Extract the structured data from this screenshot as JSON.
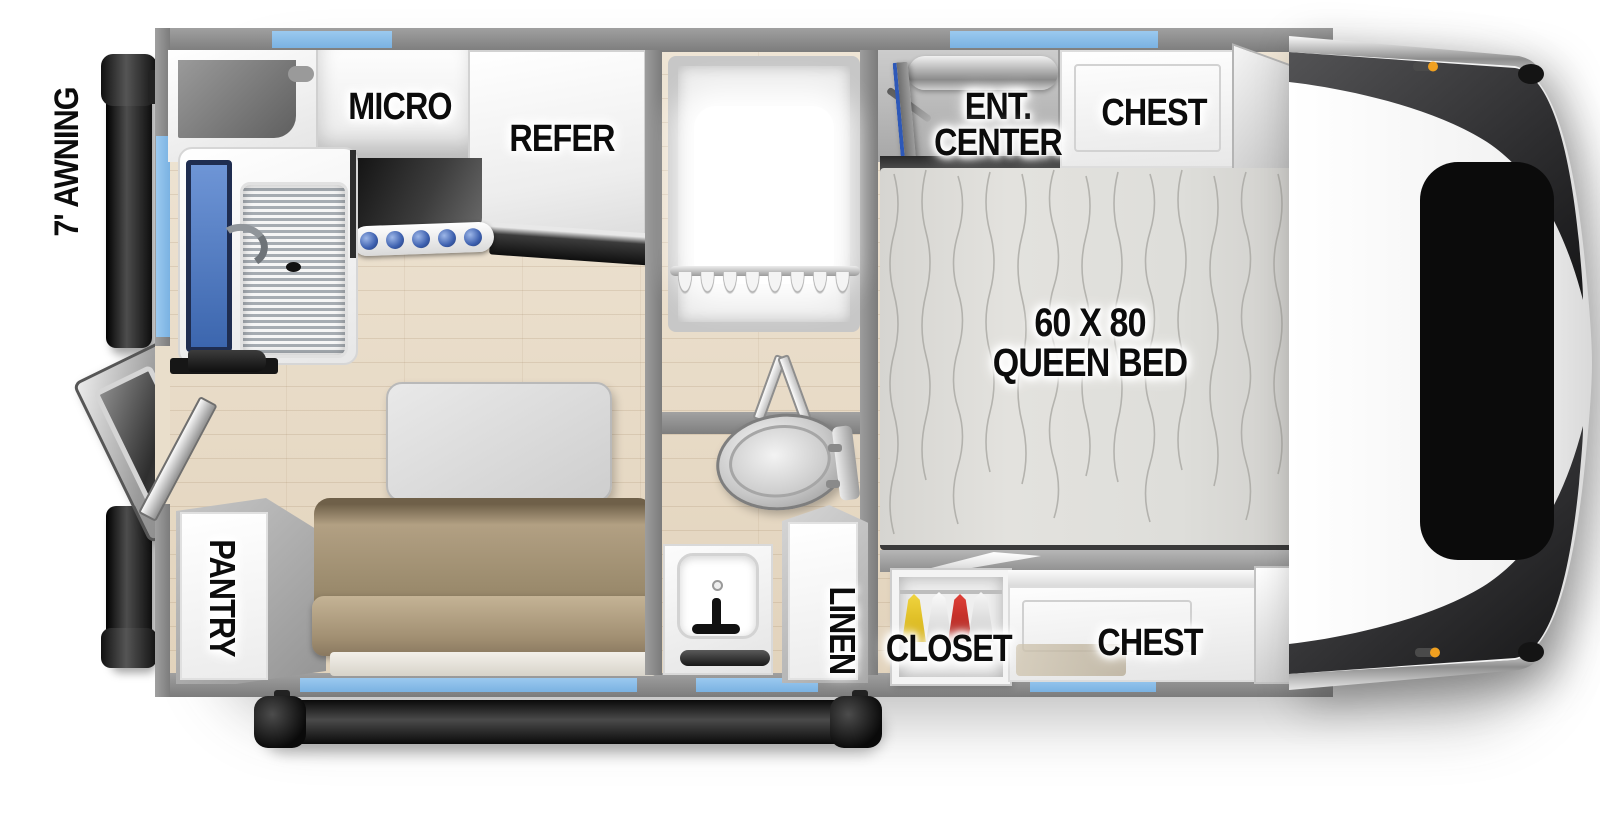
{
  "title": "Truck camper floor plan",
  "labels": {
    "awning": "7' AWNING",
    "micro": "MICRO",
    "refer": "REFER",
    "ent_line1": "ENT.",
    "ent_line2": "CENTER",
    "chest_top": "CHEST",
    "bed_line1": "60 X 80",
    "bed_line2": "QUEEN BED",
    "closet": "CLOSET",
    "linen": "LINEN",
    "chest_bottom": "CHEST",
    "pantry": "PANTRY"
  },
  "colors": {
    "wall_gray": "#8f8f8f",
    "window_blue": "#7ab2e2",
    "floor_wood": "#e9decb",
    "sofa_tan": "#9a8a6c",
    "mattress_gray": "#dededa",
    "cap_dark": "#343436",
    "marker_orange": "#f0a020",
    "stove_knob_blue": "#3c5fae",
    "sink_blue": "#3c66ae",
    "tv_blue": "#2d58b8",
    "garment_yellow": "#e0c020",
    "garment_red": "#c42a24"
  }
}
